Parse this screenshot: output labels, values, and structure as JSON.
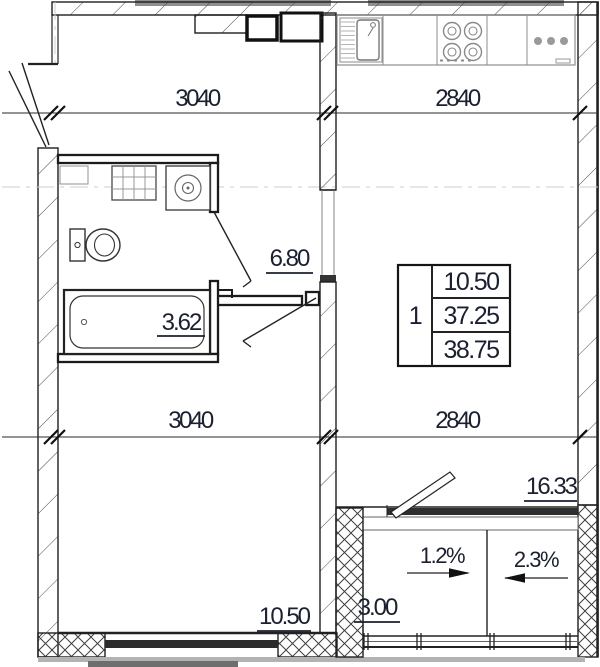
{
  "labels": {
    "dim_top_left": "3040",
    "dim_top_right": "2840",
    "dim_mid_left": "3040",
    "dim_mid_right": "2840",
    "area_hallway": "6.80",
    "area_bathroom": "3.62",
    "area_living_kitchen": "16.33",
    "area_room": "10.50",
    "area_balcony": "3.00",
    "slope_left": "1.2%",
    "slope_right": "2.3%"
  },
  "info_table": {
    "rooms": "1",
    "living_area": "10.50",
    "apartment_area": "37.25",
    "total_area": "38.75"
  },
  "colors": {
    "ink": "#1a2030",
    "line": "#1f1f1f",
    "fixture_gray": "#8e8e8e",
    "slab_gray": "#8f8f8f"
  }
}
